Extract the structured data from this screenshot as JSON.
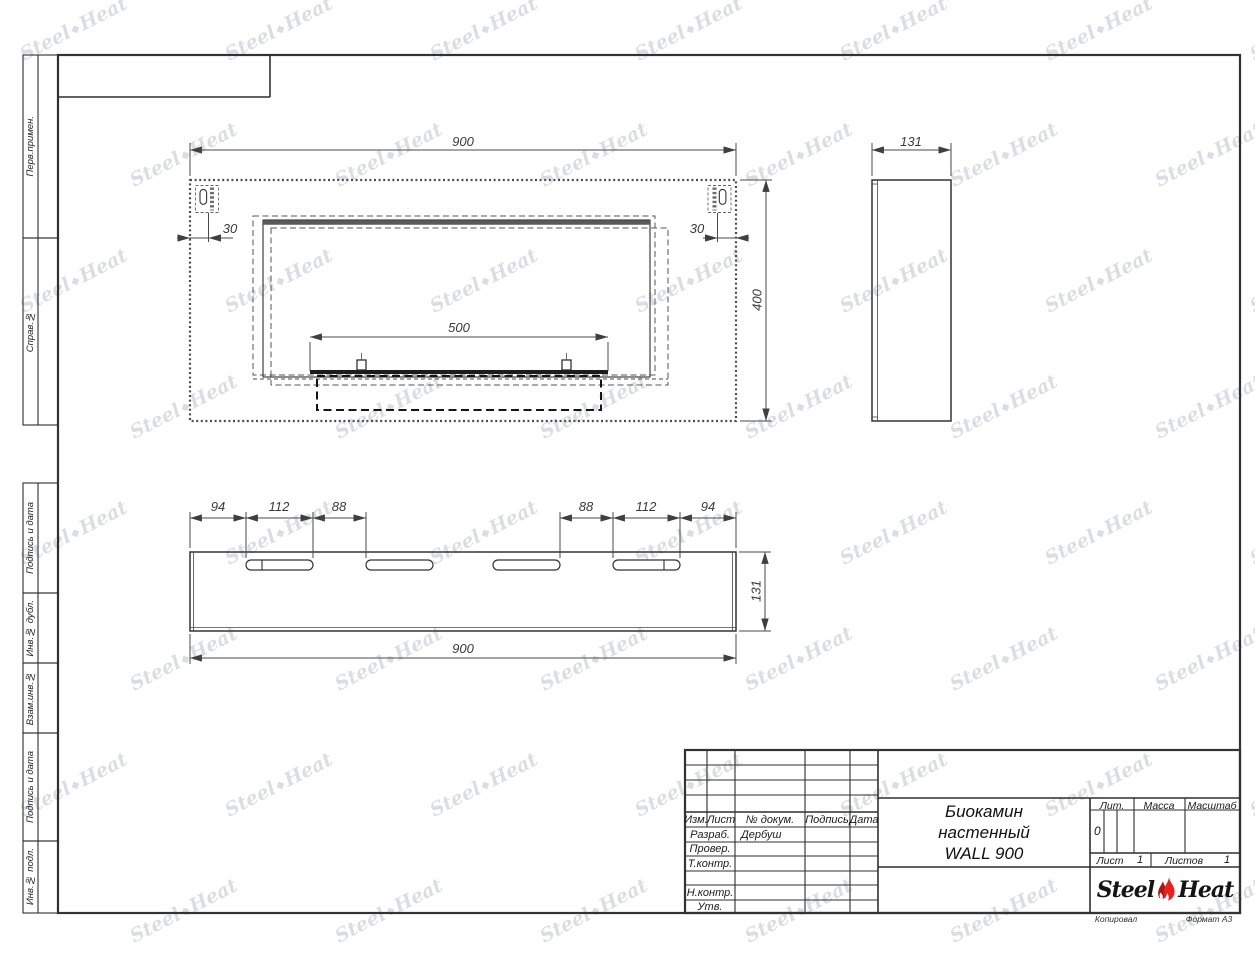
{
  "left_margin_labels": [
    "Перв.примен.",
    "Справ.№",
    "Подпись и дата",
    "Инв.№ дубл.",
    "Взам.инв.№",
    "Подпись и дата",
    "Инв.№ подл."
  ],
  "views": {
    "front": {
      "dims": {
        "width": "900",
        "height": "400",
        "burner_width": "500",
        "mount_offset_left": "30",
        "mount_offset_right": "30"
      }
    },
    "side": {
      "dims": {
        "depth": "131"
      }
    },
    "bottom": {
      "dims": {
        "width": "900",
        "depth": "131",
        "segments_left": [
          "94",
          "112",
          "88"
        ],
        "segments_right": [
          "88",
          "112",
          "94"
        ]
      }
    }
  },
  "title_block": {
    "revision_columns": [
      "Изм.",
      "Лист",
      "№ докум.",
      "Подпись",
      "Дата"
    ],
    "staff_rows": [
      {
        "label": "Разраб.",
        "value": "Дербуш"
      },
      {
        "label": "Провер.",
        "value": ""
      },
      {
        "label": "Т.контр.",
        "value": ""
      },
      {
        "label": "Н.контр.",
        "value": ""
      },
      {
        "label": "Утв.",
        "value": ""
      }
    ],
    "product_title_lines": [
      "Биокамин",
      "настенный",
      "WALL 900"
    ],
    "lit_label": "Лит.",
    "lit_value": "0",
    "mass_label": "Масса",
    "scale_label": "Масштаб",
    "sheet_label": "Лист",
    "sheet_value": "1",
    "sheets_label": "Листов",
    "sheets_value": "1",
    "logo": {
      "word1": "Steel",
      "word2": "Heat"
    }
  },
  "footer": {
    "copied_label": "Копировал",
    "format_label": "Формат А3"
  },
  "watermark": {
    "word1": "Steel",
    "word2": "Heat",
    "flame_icon": "◆"
  }
}
